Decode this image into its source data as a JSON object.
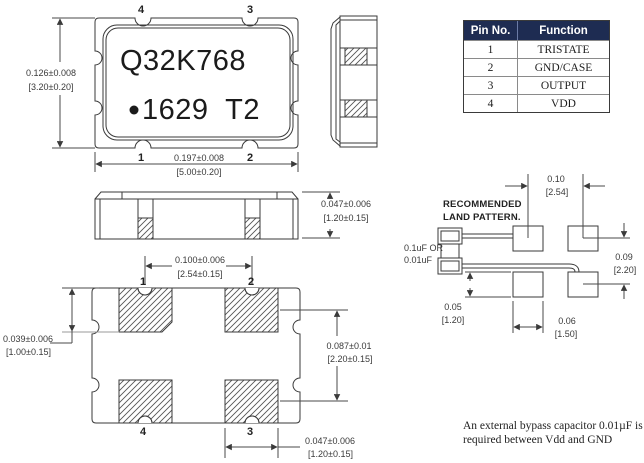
{
  "drawing": {
    "top_view": {
      "marking_line1": "Q32K768",
      "marking_line2": "1629  T2",
      "pins": {
        "top_left": "4",
        "top_right": "3",
        "bottom_left": "1",
        "bottom_right": "2"
      },
      "dim_height": {
        "in": "0.126±0.008",
        "mm": "[3.20±0.20]"
      },
      "dim_width": {
        "in": "0.197±0.008",
        "mm": "[5.00±0.20]"
      }
    },
    "front_view": {
      "dim_height": {
        "in": "0.047±0.006",
        "mm": "[1.20±0.15]"
      }
    },
    "bottom_view": {
      "pins": {
        "top_left": "1",
        "top_right": "2",
        "bottom_left": "4",
        "bottom_right": "3"
      },
      "dim_pad_pitch": {
        "in": "0.100±0.006",
        "mm": "[2.54±0.15]"
      },
      "dim_pad_length": {
        "in": "0.039±0.006",
        "mm": "[1.00±0.15]"
      },
      "dim_row_pitch": {
        "in": "0.087±0.01",
        "mm": "[2.20±0.15]"
      },
      "dim_pad_width": {
        "in": "0.047±0.006",
        "mm": "[1.20±0.15]"
      }
    },
    "land_pattern": {
      "title_line1": "RECOMMENDED",
      "title_line2": "LAND PATTERN.",
      "capacitor_label_line1": "0.1uF OR",
      "capacitor_label_line2": "0.01uF",
      "dim_col_pitch": {
        "in": "0.10",
        "mm": "[2.54]"
      },
      "dim_row_pitch": {
        "in": "0.09",
        "mm": "[2.20]"
      },
      "dim_pad_height": {
        "in": "0.05",
        "mm": "[1.20]"
      },
      "dim_pad_width": {
        "in": "0.06",
        "mm": "[1.50]"
      }
    }
  },
  "pin_table": {
    "header": {
      "col1": "Pin No.",
      "col2": "Function"
    },
    "rows": [
      {
        "pin": "1",
        "function": "TRISTATE"
      },
      {
        "pin": "2",
        "function": "GND/CASE"
      },
      {
        "pin": "3",
        "function": "OUTPUT"
      },
      {
        "pin": "4",
        "function": "VDD"
      }
    ],
    "header_bg": "#1e2c52"
  },
  "note": {
    "line1": "An external bypass capacitor 0.01µF is",
    "line2": "required between Vdd and GND"
  }
}
